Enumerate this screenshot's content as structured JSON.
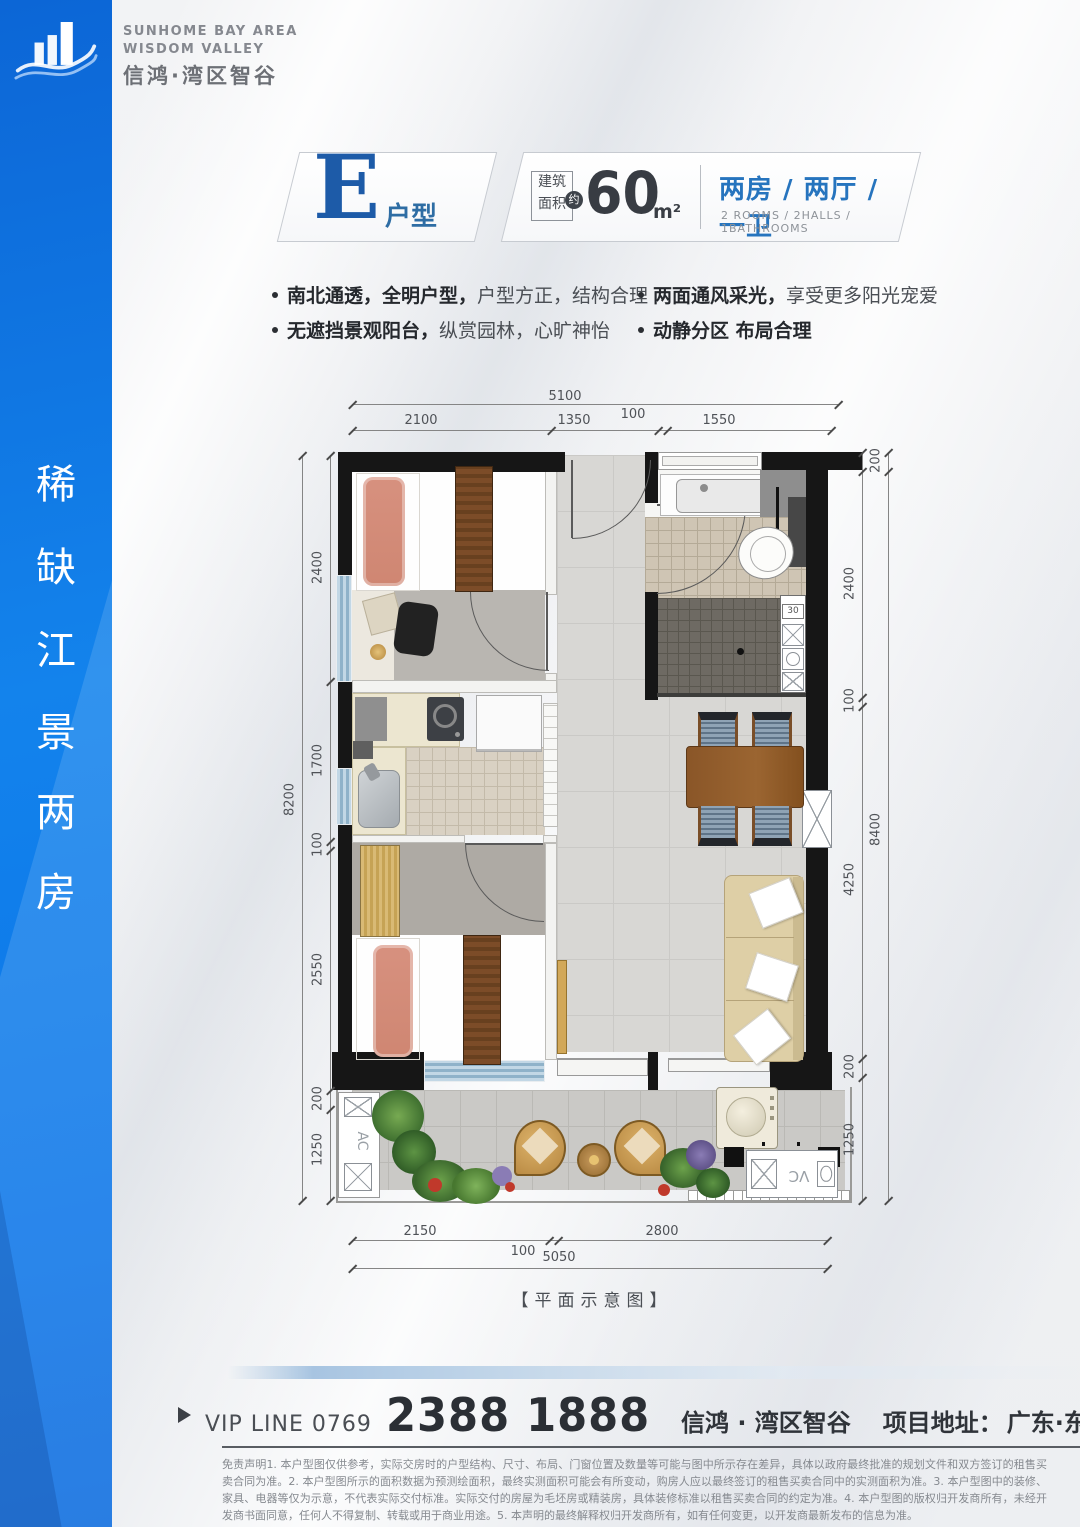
{
  "brand": {
    "en1": "SUNHOME BAY AREA",
    "en2": "WISDOM VALLEY",
    "cn": "信鸿·湾区智谷"
  },
  "sidebar": {
    "chars": [
      "稀",
      "缺",
      "江",
      "景",
      "两",
      "房"
    ]
  },
  "title": {
    "letter": "E",
    "suffix": "户型",
    "area_l1": "建筑",
    "area_l2": "面积",
    "approx": "约",
    "area": "60",
    "unit": "m²",
    "rooms_cn": "两房 / 两厅 / 一卫",
    "rooms_en": "2 ROOMS / 2HALLS / 1BATHROOMS"
  },
  "features": {
    "left": [
      {
        "bold": "南北通透，全明户型，",
        "rest": "户型方正，结构合理"
      },
      {
        "bold": "无遮挡景观阳台，",
        "rest": "纵赏园林，心旷神怡"
      }
    ],
    "right": [
      {
        "bold": "两面通风采光，",
        "rest": "享受更多阳光宠爱"
      },
      {
        "bold": "动静分区 布局合理",
        "rest": ""
      }
    ]
  },
  "plan": {
    "caption": "【平面示意图】",
    "labels": {
      "ac": "AC",
      "vc": "VC",
      "stove": "30"
    },
    "dims": {
      "top_total": "5100",
      "top": [
        "2100",
        "1350",
        "100",
        "1550"
      ],
      "bottom": [
        "2150",
        "100",
        "2800"
      ],
      "bottom_total": "5050",
      "left": [
        "2400",
        "1700",
        "100",
        "2550",
        "200",
        "1250"
      ],
      "left_total": "8200",
      "right_top": "200",
      "right": [
        "2400",
        "100",
        "4250",
        "200",
        "1250"
      ],
      "right_total": "8400"
    }
  },
  "footer": {
    "vip": "VIP LINE 0769",
    "phone": "2388 1888",
    "brand": "信鸿 · 湾区智谷",
    "address_label": "项目地址：",
    "address": "广东·东莞·沙田镇西太隆",
    "disclaimer": "免责声明1. 本户型图仅供参考，实际交房时的户型结构、尺寸、布局、门窗位置及数量等可能与图中所示存在差异，具体以政府最终批准的规划文件和双方签订的租售买卖合同为准。2. 本户型图所示的面积数据为预测绘面积，最终实测面积可能会有所变动，购房人应以最终签订的租售买卖合同中的实测面积为准。3. 本户型图中的装修、家具、电器等仅为示意，不代表实际交付标准。实际交付的房屋为毛坯房或精装房，具体装修标准以租售买卖合同的约定为准。4. 本户型图的版权归开发商所有，未经开发商书面同意，任何人不得复制、转载或用于商业用途。5. 本声明的最终解释权归开发商所有，如有任何变更，以开发商最新发布的信息为准。"
  }
}
